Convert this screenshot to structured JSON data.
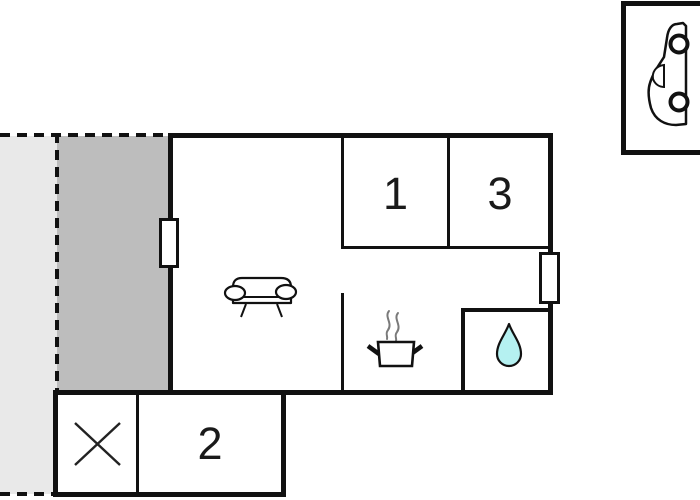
{
  "floorplan": {
    "rooms": [
      {
        "label": "1"
      },
      {
        "label": "2"
      },
      {
        "label": "3"
      }
    ],
    "icons": [
      "car-icon",
      "sofa-icon",
      "cooking-pot-icon",
      "steam-icon",
      "water-drop-icon",
      "cross-icon",
      "window-left",
      "window-right"
    ],
    "colors": {
      "wall": "#111111",
      "terrace_light": "#e9e9e9",
      "terrace_dark": "#bdbdbd",
      "water_drop_fill": "#b5f1f1",
      "steam": "#7a7a7a"
    }
  }
}
